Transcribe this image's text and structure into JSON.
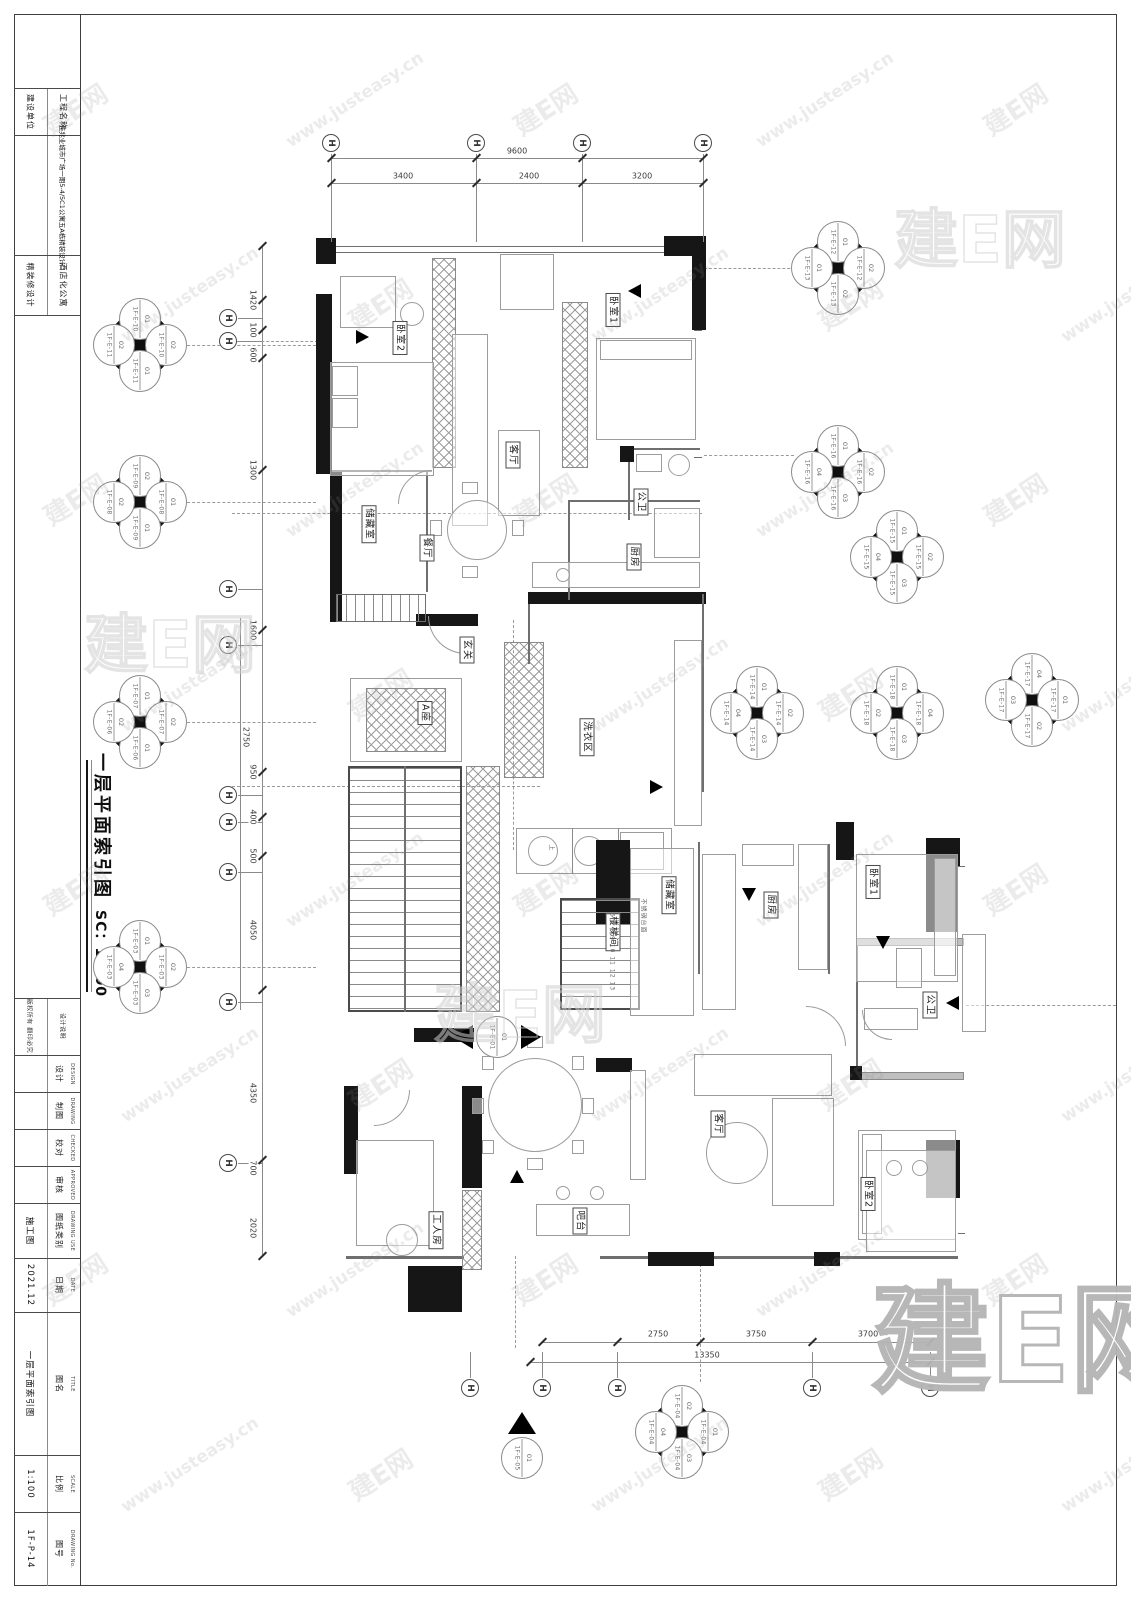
{
  "watermark": {
    "tile_a": "建E网",
    "tile_b": "www.justeasy.cn",
    "logo": "建E网"
  },
  "titleblock": {
    "top_rows": [
      {
        "right": "工程名称",
        "left": "建设单位"
      },
      {
        "right": "佳兆业城市广场一期5-4/5C1公寓五A栋精装设计",
        "left": ""
      },
      {
        "right": "酒店化公寓",
        "left": "精装修设计"
      }
    ],
    "notice": {
      "right": "设计说明",
      "left": "版权所有 翻印必究"
    },
    "rows": [
      {
        "cn": "设计",
        "en": "DESIGN",
        "value": ""
      },
      {
        "cn": "制图",
        "en": "DRAWING",
        "value": ""
      },
      {
        "cn": "校对",
        "en": "CHECKED",
        "value": ""
      },
      {
        "cn": "审核",
        "en": "APPROVED",
        "value": ""
      },
      {
        "cn": "图纸类别",
        "en": "DRAWING USE",
        "value": "施工图"
      },
      {
        "cn": "日期",
        "en": "DATE",
        "value": "2021.12"
      },
      {
        "cn": "图名",
        "en": "TITLE",
        "value": "一层平面索引图"
      },
      {
        "cn": "比例",
        "en": "SCALE",
        "value": "1:100"
      },
      {
        "cn": "图号",
        "en": "DRAWING No.",
        "value": "1F-P-14"
      }
    ]
  },
  "plan_title": {
    "text": "一层平面索引图",
    "scale": "SC：1:100"
  },
  "rooms": [
    {
      "t": "卧室2",
      "x": 400,
      "y": 338
    },
    {
      "t": "客厅",
      "x": 513,
      "y": 455
    },
    {
      "t": "卧室1",
      "x": 613,
      "y": 310
    },
    {
      "t": "公卫",
      "x": 641,
      "y": 502
    },
    {
      "t": "厨房",
      "x": 634,
      "y": 557
    },
    {
      "t": "储藏室",
      "x": 369,
      "y": 524
    },
    {
      "t": "餐厅",
      "x": 427,
      "y": 548
    },
    {
      "t": "玄关",
      "x": 467,
      "y": 650
    },
    {
      "t": "A座",
      "x": 425,
      "y": 713
    },
    {
      "t": "洗衣区",
      "x": 587,
      "y": 737
    },
    {
      "t": "楼梯间",
      "x": 613,
      "y": 932
    },
    {
      "t": "储藏室",
      "x": 669,
      "y": 895
    },
    {
      "t": "厨房",
      "x": 771,
      "y": 905
    },
    {
      "t": "卧室1",
      "x": 873,
      "y": 882
    },
    {
      "t": "公卫",
      "x": 930,
      "y": 1005
    },
    {
      "t": "客厅",
      "x": 718,
      "y": 1124
    },
    {
      "t": "卧室2",
      "x": 868,
      "y": 1194
    },
    {
      "t": "工人房",
      "x": 436,
      "y": 1230
    },
    {
      "t": "吧台",
      "x": 580,
      "y": 1221
    }
  ],
  "small_texts": [
    {
      "t": "6 7 8 9 10 11 12 13",
      "x": 612,
      "y": 952
    },
    {
      "t": "不锈钢台面",
      "x": 644,
      "y": 916
    },
    {
      "t": "上",
      "x": 552,
      "y": 848
    }
  ],
  "grid": {
    "glyph": "H",
    "top": [
      331,
      476,
      582,
      703
    ],
    "left": [
      318,
      341,
      589,
      645,
      795,
      822,
      872,
      1002,
      1163
    ],
    "bottom": [
      470,
      542,
      617,
      812,
      930
    ]
  },
  "dims": {
    "top_total": {
      "v": "9600",
      "x": 517,
      "y": 151
    },
    "top_segs": [
      {
        "v": "3400",
        "x": 403
      },
      {
        "v": "2400",
        "x": 529
      },
      {
        "v": "3200",
        "x": 642
      }
    ],
    "left": [
      {
        "v": "1420",
        "y": 300
      },
      {
        "v": "100",
        "y": 330
      },
      {
        "v": "600",
        "y": 355
      },
      {
        "v": "1300",
        "y": 470
      },
      {
        "v": "1600",
        "y": 630
      },
      {
        "v": "2750",
        "y": 737
      },
      {
        "v": "950",
        "y": 772
      },
      {
        "v": "400",
        "y": 817
      },
      {
        "v": "500",
        "y": 856
      },
      {
        "v": "4050",
        "y": 930
      },
      {
        "v": "4350",
        "y": 1093
      },
      {
        "v": "700",
        "y": 1168
      },
      {
        "v": "2020",
        "y": 1228
      }
    ],
    "bottom": [
      {
        "v": "2750",
        "x": 658
      },
      {
        "v": "3750",
        "x": 756
      },
      {
        "v": "3700",
        "x": 868
      }
    ],
    "bottom_total": {
      "v": "13350",
      "x": 707,
      "y": 1355
    },
    "bottom_ticks": [
      542,
      617,
      700,
      812,
      930
    ]
  },
  "markers": [
    {
      "type": "quad",
      "x": 140,
      "y": 345,
      "views": {
        "t": [
          "01",
          "1F-E-10"
        ],
        "r": [
          "02",
          "1F-E-10"
        ],
        "b": [
          "01",
          "1F-E-11"
        ],
        "l": [
          "02",
          "1F-E-11"
        ]
      }
    },
    {
      "type": "quad",
      "x": 140,
      "y": 502,
      "views": {
        "t": [
          "02",
          "1F-E-09"
        ],
        "r": [
          "01",
          "1F-E-08"
        ],
        "b": [
          "01",
          "1F-E-09"
        ],
        "l": [
          "02",
          "1F-E-08"
        ]
      }
    },
    {
      "type": "quad",
      "x": 838,
      "y": 268,
      "views": {
        "t": [
          "01",
          "1F-E-12"
        ],
        "r": [
          "02",
          "1F-E-12"
        ],
        "b": [
          "02",
          "1F-E-13"
        ],
        "l": [
          "01",
          "1F-E-13"
        ]
      }
    },
    {
      "type": "quad",
      "x": 838,
      "y": 472,
      "views": {
        "t": [
          "01",
          "1F-E-16"
        ],
        "r": [
          "02",
          "1F-E-16"
        ],
        "b": [
          "03",
          "1F-E-16"
        ],
        "l": [
          "04",
          "1F-E-16"
        ]
      }
    },
    {
      "type": "quad",
      "x": 897,
      "y": 557,
      "views": {
        "t": [
          "01",
          "1F-E-15"
        ],
        "r": [
          "02",
          "1F-E-15"
        ],
        "b": [
          "03",
          "1F-E-15"
        ],
        "l": [
          "04",
          "1F-E-15"
        ]
      }
    },
    {
      "type": "quad",
      "x": 140,
      "y": 722,
      "views": {
        "t": [
          "01",
          "1F-E-07"
        ],
        "r": [
          "02",
          "1F-E-07"
        ],
        "b": [
          "01",
          "1F-E-06"
        ],
        "l": [
          "02",
          "1F-E-06"
        ]
      }
    },
    {
      "type": "quad",
      "x": 757,
      "y": 713,
      "views": {
        "t": [
          "01",
          "1F-E-14"
        ],
        "r": [
          "02",
          "1F-E-14"
        ],
        "b": [
          "03",
          "1F-E-14"
        ],
        "l": [
          "04",
          "1F-E-14"
        ]
      }
    },
    {
      "type": "quad",
      "x": 897,
      "y": 713,
      "views": {
        "t": [
          "01",
          "1F-E-18"
        ],
        "r": [
          "04",
          "1F-E-18"
        ],
        "b": [
          "03",
          "1F-E-18"
        ],
        "l": [
          "02",
          "1F-E-18"
        ]
      }
    },
    {
      "type": "quad",
      "x": 1032,
      "y": 700,
      "views": {
        "t": [
          "04",
          "1F-E-17"
        ],
        "r": [
          "01",
          "1F-E-17"
        ],
        "b": [
          "02",
          "1F-E-17"
        ],
        "l": [
          "03",
          "1F-E-17"
        ]
      }
    },
    {
      "type": "quad",
      "x": 140,
      "y": 967,
      "views": {
        "t": [
          "01",
          "1F-E-03"
        ],
        "r": [
          "02",
          "1F-E-03"
        ],
        "b": [
          "03",
          "1F-E-03"
        ],
        "l": [
          "04",
          "1F-E-03"
        ]
      }
    },
    {
      "type": "quad",
      "x": 682,
      "y": 1432,
      "views": {
        "t": [
          "02",
          "1F-E-04"
        ],
        "r": [
          "01",
          "1F-E-04"
        ],
        "b": [
          "03",
          "1F-E-04"
        ],
        "l": [
          "04",
          "1F-E-04"
        ]
      }
    },
    {
      "type": "single-lr",
      "x": 497,
      "y": 1037,
      "num": "01",
      "sheet": "1F-E-01"
    },
    {
      "type": "single-up",
      "x": 522,
      "y": 1458,
      "num": "01",
      "sheet": "1F-E-05"
    }
  ]
}
